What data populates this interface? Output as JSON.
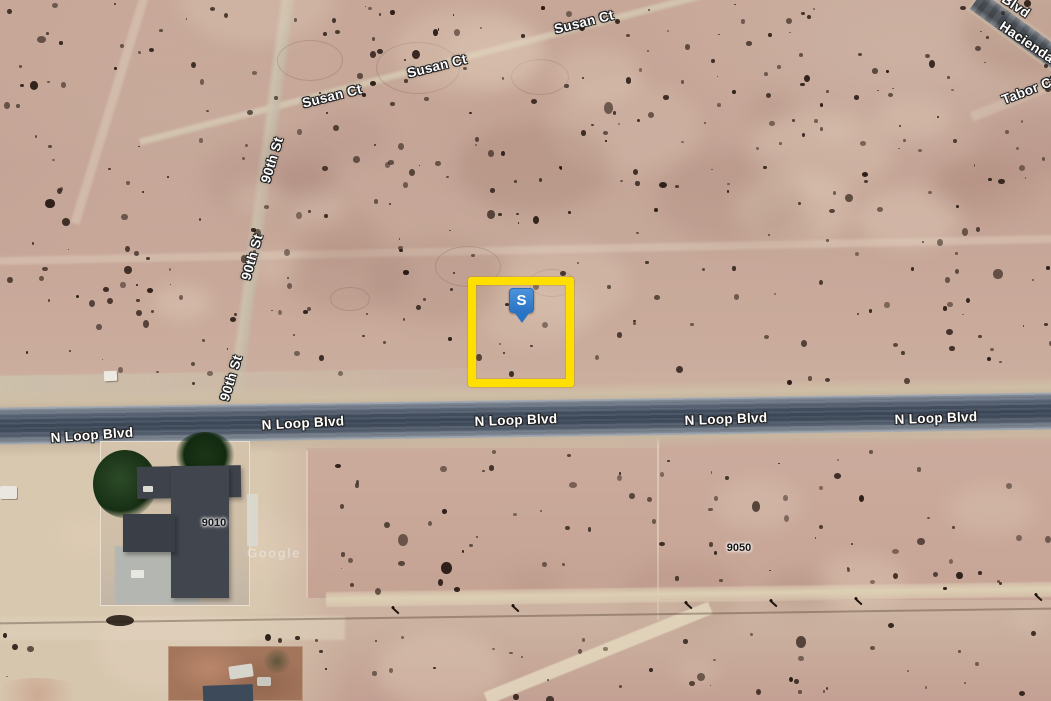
{
  "app": {
    "type": "satellite-map",
    "description": "Aerial satellite view of desert parcels with highlighted lot"
  },
  "watermark": {
    "text": "Google"
  },
  "marker": {
    "label": "S"
  },
  "parcel_highlight": {
    "outline_color": "#ffdf00"
  },
  "colors": {
    "marker_blue": "#2e7ecd",
    "asphalt": "#475364",
    "desert": "#c6a697"
  },
  "street_labels": [
    {
      "id": "road-label-n-loop-blvd-1",
      "text": "N Loop Blvd",
      "x": 92,
      "y": 435,
      "rot": -4
    },
    {
      "id": "road-label-n-loop-blvd-2",
      "text": "N Loop Blvd",
      "x": 303,
      "y": 423,
      "rot": -3
    },
    {
      "id": "road-label-n-loop-blvd-3",
      "text": "N Loop Blvd",
      "x": 516,
      "y": 420,
      "rot": -2
    },
    {
      "id": "road-label-n-loop-blvd-4",
      "text": "N Loop Blvd",
      "x": 726,
      "y": 419,
      "rot": -2
    },
    {
      "id": "road-label-n-loop-blvd-5",
      "text": "N Loop Blvd",
      "x": 936,
      "y": 418,
      "rot": -2
    },
    {
      "id": "road-label-susan-ct-1",
      "text": "Susan Ct",
      "x": 332,
      "y": 96,
      "rot": -14
    },
    {
      "id": "road-label-susan-ct-2",
      "text": "Susan Ct",
      "x": 437,
      "y": 66,
      "rot": -14
    },
    {
      "id": "road-label-susan-ct-3",
      "text": "Susan Ct",
      "x": 584,
      "y": 22,
      "rot": -14
    },
    {
      "id": "road-label-90th-st-1",
      "text": "90th St",
      "x": 272,
      "y": 160,
      "rot": -73
    },
    {
      "id": "road-label-90th-st-2",
      "text": "90th St",
      "x": 252,
      "y": 257,
      "rot": -74
    },
    {
      "id": "road-label-90th-st-3",
      "text": "90th St",
      "x": 231,
      "y": 378,
      "rot": -73
    },
    {
      "id": "road-label-blvd-partial",
      "text": "Blvd",
      "x": 1016,
      "y": 6,
      "rot": 34
    },
    {
      "id": "road-label-hacienda",
      "text": "Hacienda",
      "x": 1027,
      "y": 42,
      "rot": 34
    },
    {
      "id": "road-label-tabor-ct",
      "text": "Tabor Ct",
      "x": 1029,
      "y": 90,
      "rot": -21
    }
  ],
  "lot_numbers": [
    {
      "id": "lot-number-9010",
      "text": "9010",
      "x": 214,
      "y": 523,
      "rot": 0
    },
    {
      "id": "lot-number-9050",
      "text": "9050",
      "x": 739,
      "y": 548,
      "rot": 0
    }
  ]
}
